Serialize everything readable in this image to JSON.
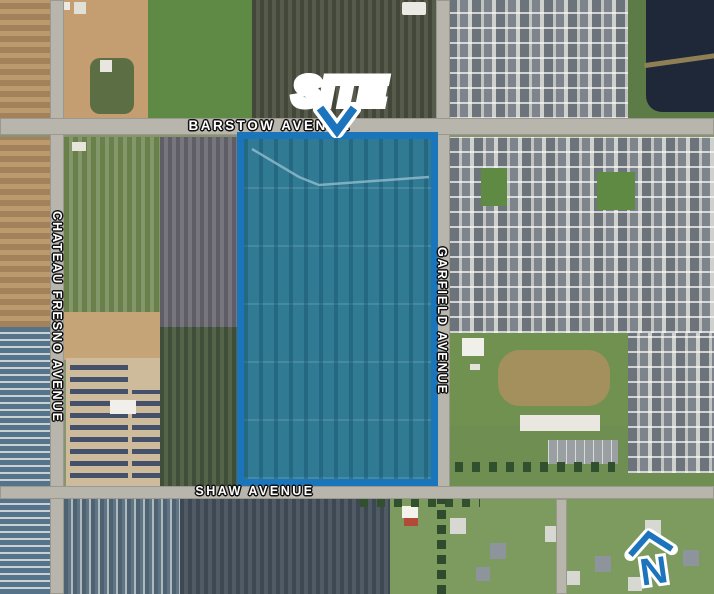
{
  "map": {
    "description": "Aerial site location exhibit",
    "annotations": {
      "site_label": "SITE",
      "north_label": "N"
    },
    "roads": {
      "barstow": "BARSTOW AVENUE",
      "chateau_fresno": "CHATEAU FRESNO AVENUE",
      "garfield": "GARFIELD AVENUE",
      "shaw": "SHAW AVENUE"
    },
    "colors": {
      "annotation_blue": "#1b75bc",
      "site_fill_teal": "#2e7f9e",
      "road_label": "#ffffff",
      "label_outline": "#111111"
    }
  }
}
